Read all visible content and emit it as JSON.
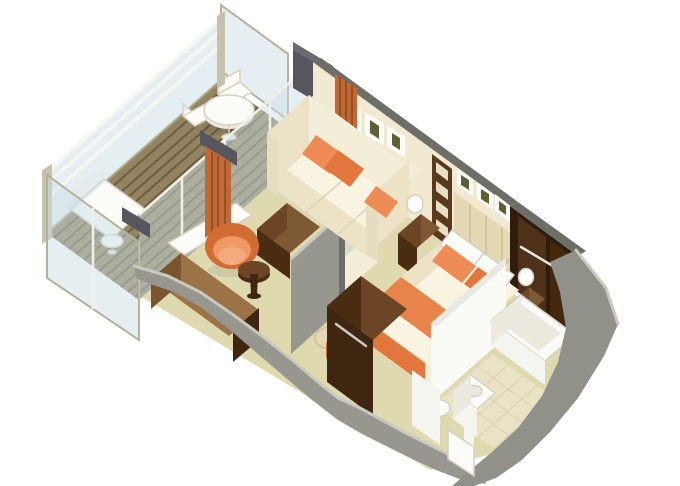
{
  "scene": {
    "title": "3D isometric cutaway floor plan of a suite with veranda, living room, bedroom, bathroom and entry",
    "rooms": [
      {
        "name": "veranda",
        "furniture": [
          "glass-railing",
          "balcony-privacy-divider",
          "wood-plank-deck",
          "round-dining-table",
          "dining-chair",
          "dining-chair",
          "chaise-lounge",
          "small-side-table",
          "end-glass-panel"
        ]
      },
      {
        "name": "living-room",
        "furniture": [
          "sliding-glass-doors",
          "orange-curtains",
          "door-threshold",
          "sofa",
          "throw-pillows",
          "wall-art-frames",
          "ottoman-coffee-table",
          "swivel-tub-chair",
          "round-side-table",
          "writing-desk",
          "low-sideboard",
          "glass-partition",
          "partition-panel"
        ]
      },
      {
        "name": "bedroom",
        "furniture": [
          "double-bed",
          "orange-bed-runner",
          "bed-pillows",
          "headboard-panels",
          "small-wall-art",
          "nightstand",
          "nightstand",
          "table-lamp",
          "table-lamp",
          "shelf-unit",
          "tv-wardrobe-cabinet",
          "vanity-table",
          "vanity-stool",
          "walk-in-closet",
          "closet-hanging-rail"
        ]
      },
      {
        "name": "bathroom",
        "furniture": [
          "bathtub",
          "vanity-sink",
          "toilet",
          "tile-floor",
          "bath-partition-wall"
        ]
      },
      {
        "name": "entry",
        "furniture": [
          "entry-door",
          "cutaway-outer-wall"
        ]
      }
    ]
  },
  "palette": {
    "bg": "#ffffff",
    "carpet": "#dfd9b0",
    "deck": "#938360",
    "deck_slat": "#6e5e40",
    "deck_edge": "#a99a74",
    "glass": "#c8dde4",
    "glass_frame": "#b5b09c",
    "mullion": "#f0efe8",
    "rail_white": "#f7f7f2",
    "post_tan": "#c6c1ab",
    "wall_cream": "#f1e9d1",
    "wall_cap": "#6e6e68",
    "post_grey": "#56565c",
    "post_grey_light": "#6a6a70",
    "outer_grey": "#97978f",
    "outer_grey2": "#91918a",
    "cut_light": "#c9c9c0",
    "headboard": "#e5d8b4",
    "headboard_seam": "#cdbd94",
    "wood_dark": "#4a2c12",
    "wood_mid": "#6b4526",
    "wood_top": "#7d5a33",
    "wood_desk": "#9b7347",
    "wood_desk_front": "#7a5630",
    "wood_end": "#3f2610",
    "shelf_wood": "#5a3a1e",
    "shelf_slot": "#e8dfc4",
    "closet_shadow": "#2f1d0c",
    "closet_door": "#4e3118",
    "closet_door2": "#44290f",
    "rail_metal": "#e9e5db",
    "orange": "#e8834a",
    "orange_light": "#ef8c55",
    "orange_dark": "#e2763c",
    "curtain": "#bf6a36",
    "curtain_fold": "#9a4f20",
    "chair_shell": "#d06c34",
    "chair_inner": "#ef9a66",
    "chair_cushion": "#f3aa7c",
    "sofa_cream": "#f4eed8",
    "sofa_light": "#f9f4e2",
    "sofa_mid": "#ece2c6",
    "sofa_dark": "#e6dcc0",
    "sofa_seam": "#ddd3b6",
    "white_fix": "#fbfbf7",
    "white_dim": "#eceadf",
    "white_wall": "#f5f5ef",
    "white_wall2": "#fafaf6",
    "fix_stroke": "#d5d2c4",
    "tile": "#eae2c4",
    "tile_line": "#d9d0ae",
    "frame_white": "#fbfaf4",
    "art_dark": "#5f5f35",
    "lamp": "#fdfdf9",
    "handle": "#cfcbc0"
  }
}
